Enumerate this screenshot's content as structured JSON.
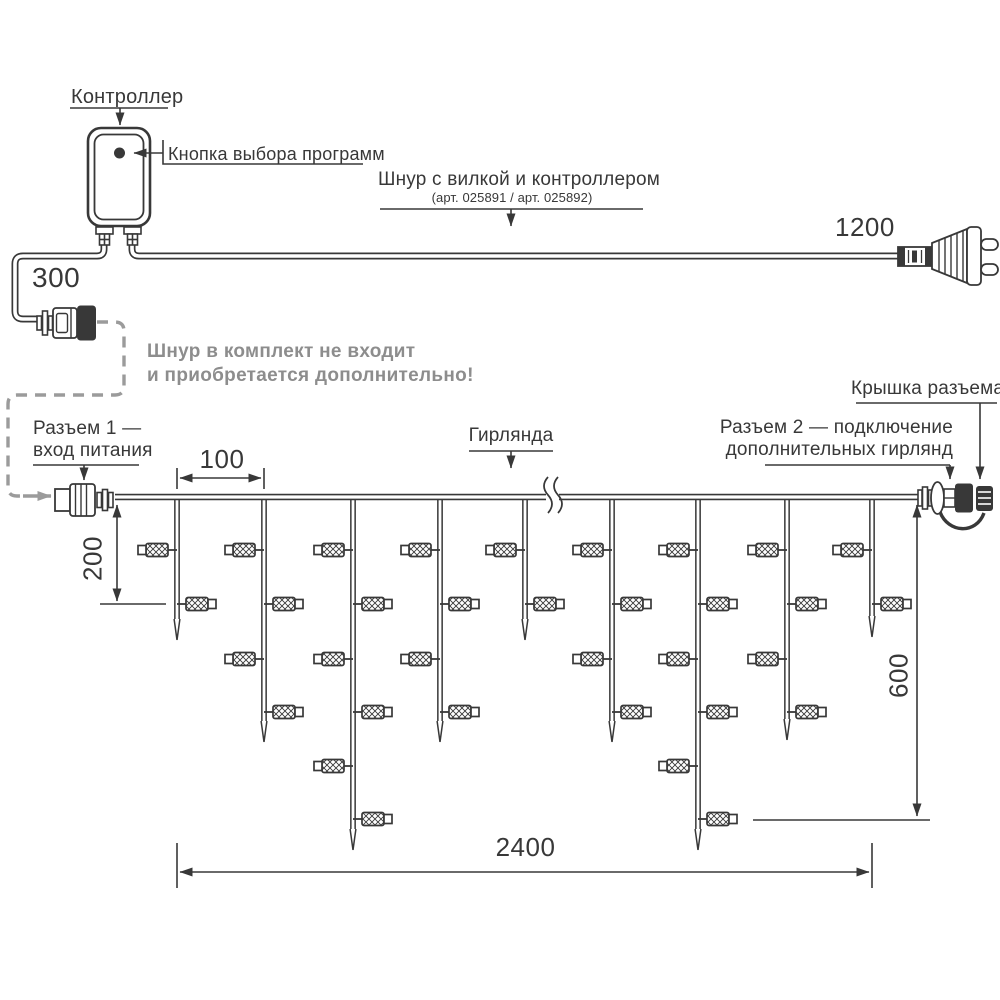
{
  "diagram": {
    "controller": {
      "label": "Контроллер",
      "button_label": "Кнопка выбора программ"
    },
    "power_cord": {
      "label": "Шнур с вилкой и контроллером",
      "articles": "(арт. 025891 / арт. 025892)",
      "length_to_plug": "1200",
      "length_to_connector": "300"
    },
    "note": {
      "line1": "Шнур в комплект не входит",
      "line2": "и приобретается дополнительно!"
    },
    "connector1": {
      "line1": "Разъем 1 —",
      "line2": "вход питания"
    },
    "garland_label": "Гирлянда",
    "connector_cap_label": "Крышка разъема",
    "connector2": {
      "line1": "Разъем 2 — подключение",
      "line2": "дополнительных гирлянд"
    },
    "dimensions": {
      "drop_spacing": "100",
      "short_drop": "200",
      "long_drop": "600",
      "total_length": "2400"
    }
  },
  "garland": {
    "wire_y": 497,
    "x_start": 115,
    "x_end": 918,
    "break_x": 552,
    "bulb_levels": [
      550,
      604,
      659,
      712,
      766,
      819
    ],
    "drops": [
      {
        "x": 177,
        "tip_y": 640,
        "bulbs": 2
      },
      {
        "x": 264,
        "tip_y": 742,
        "bulbs": 4
      },
      {
        "x": 353,
        "tip_y": 850,
        "bulbs": 6
      },
      {
        "x": 440,
        "tip_y": 742,
        "bulbs": 4
      },
      {
        "x": 525,
        "tip_y": 640,
        "bulbs": 2
      },
      {
        "x": 612,
        "tip_y": 742,
        "bulbs": 4
      },
      {
        "x": 698,
        "tip_y": 850,
        "bulbs": 6
      },
      {
        "x": 787,
        "tip_y": 740,
        "bulbs": 4
      },
      {
        "x": 872,
        "tip_y": 637,
        "bulbs": 2
      }
    ]
  },
  "colors": {
    "line": "#383838",
    "note_grey": "#8d8d8d",
    "dashed_grey": "#9b9b9b",
    "background": "#ffffff"
  }
}
